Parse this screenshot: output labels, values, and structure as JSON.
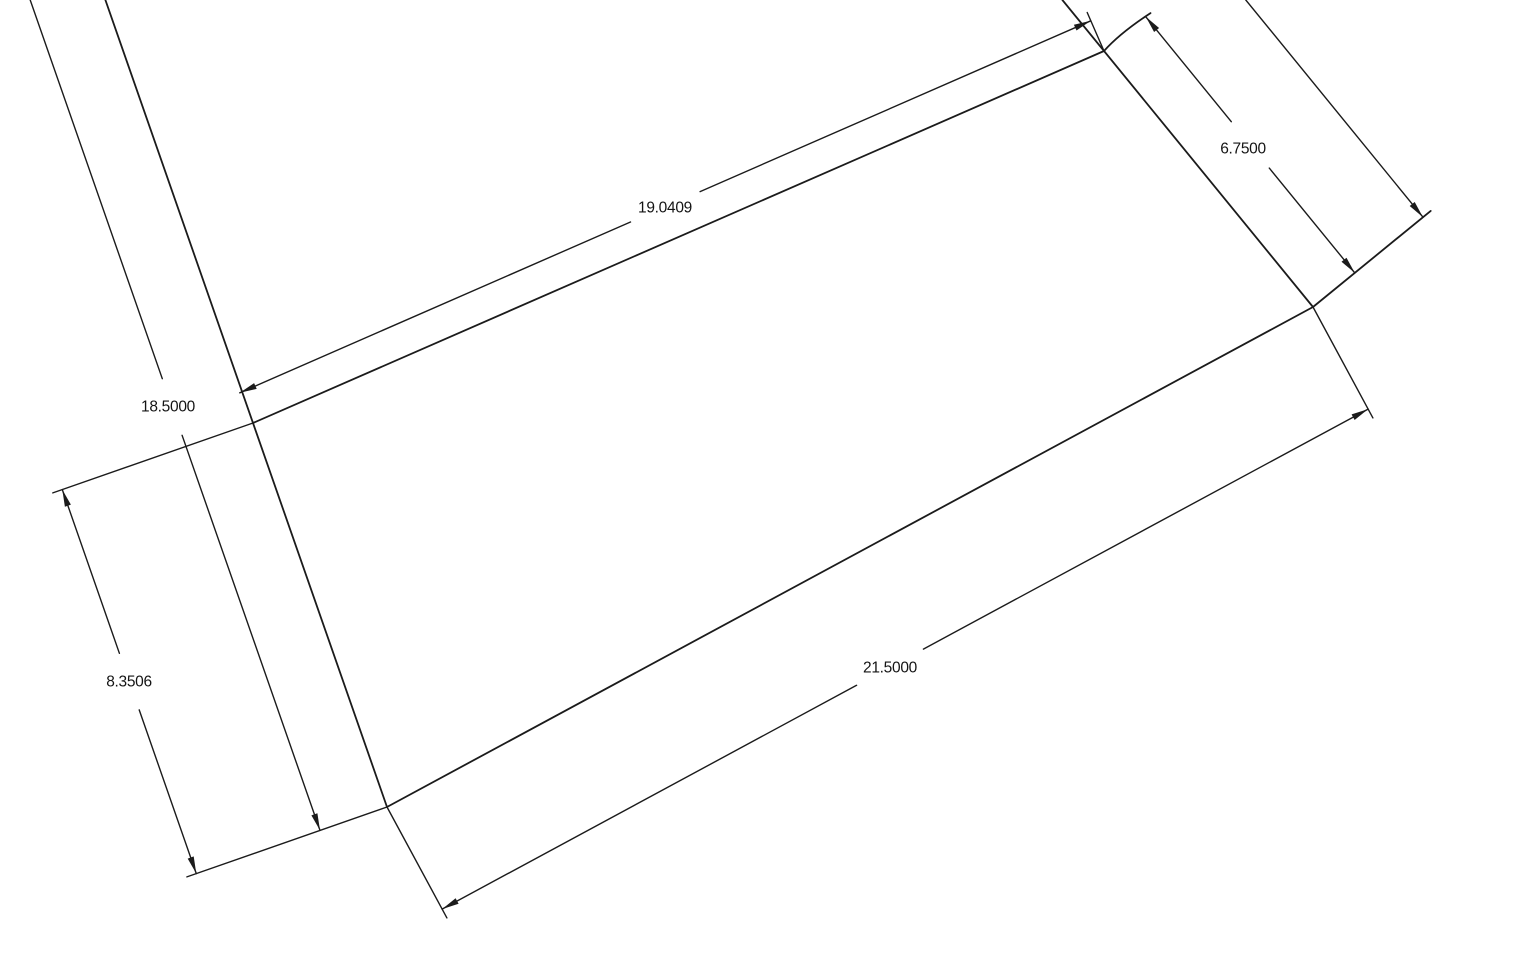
{
  "drawing": {
    "background_color": "#ffffff",
    "line_color": "#1b1b1b",
    "dimensions": {
      "top_width": {
        "value": "19.0409"
      },
      "right_flap_length": {
        "value": "6.7500"
      },
      "left_strip_length": {
        "value": "18.5000"
      },
      "left_side_length": {
        "value": "8.3506"
      },
      "bottom_width": {
        "value": "21.5000"
      }
    }
  }
}
